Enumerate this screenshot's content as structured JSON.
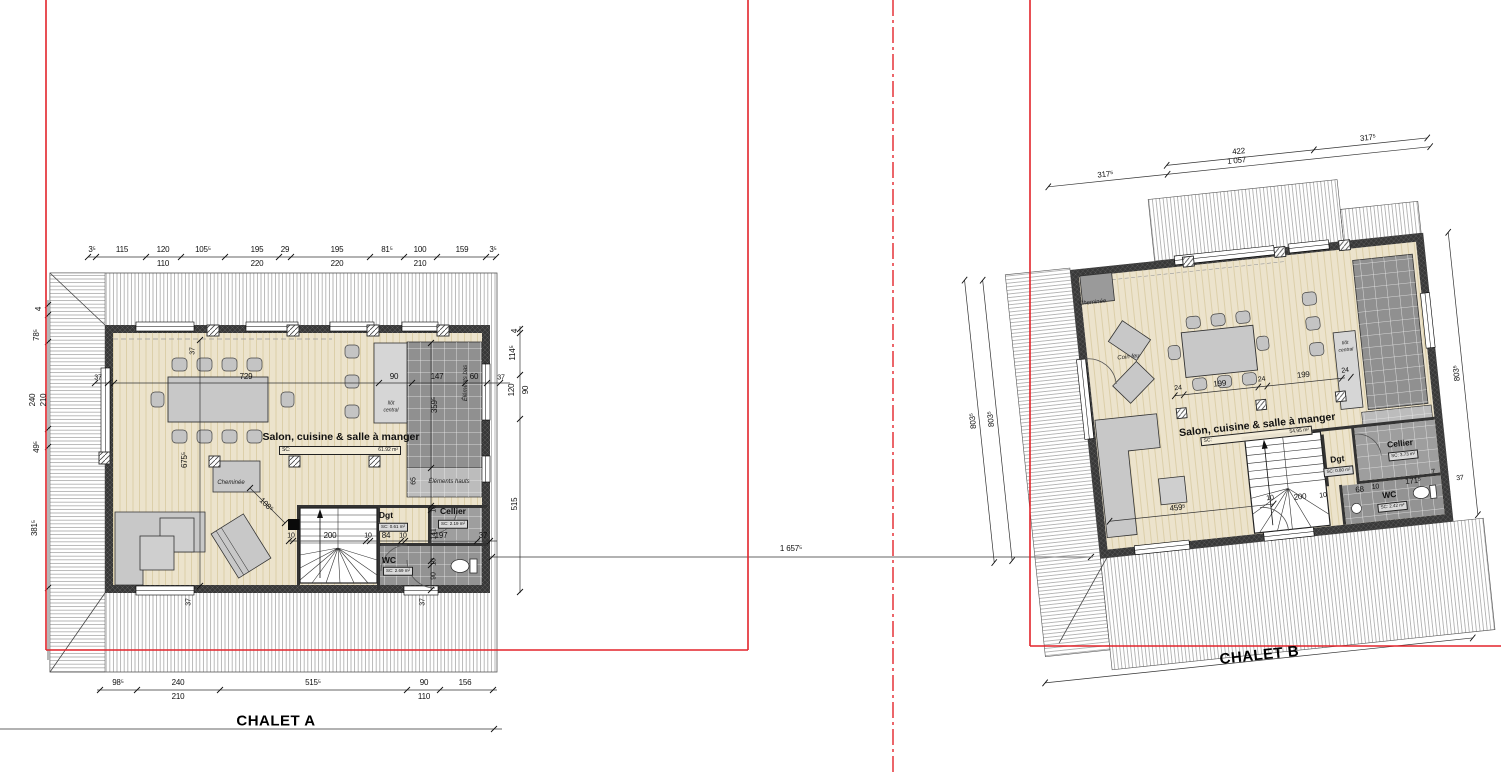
{
  "colors": {
    "boundary_red": "#e3242b",
    "wall_dark": "#383838",
    "floor_beige": "#ece3cc",
    "counter_gray": "#909090",
    "furniture_gray": "#c8c8c8"
  },
  "parcel": {
    "between_dim": "1 657⁵"
  },
  "chaletA": {
    "title": "CHALET A",
    "salon": {
      "name": "Salon, cuisine & salle à manger",
      "sc_label": "SC:",
      "sc_value": "61.92 m²"
    },
    "rooms": {
      "dgt": "Dgt",
      "dgt_sc": "SC: 0.61 m²",
      "cellier": "Cellier",
      "cellier_sc": "SC: 2.19 m²",
      "wc": "WC",
      "wc_sc": "SC: 2.69 m²"
    },
    "features": {
      "cheminee": "Cheminée",
      "ilot_line1": "Ilôt",
      "ilot_line2": "central",
      "elements_bas": "Éléments bas",
      "elements_hauts": "Éléments hauts"
    },
    "dims": {
      "top_primary": [
        "3⁵",
        "115",
        "120",
        "105⁵",
        "195",
        "29",
        "195",
        "81⁵",
        "100",
        "159",
        "3⁵"
      ],
      "top_secondary": [
        "110",
        "220",
        "220",
        "210"
      ],
      "left": [
        "4",
        "78⁵",
        "240",
        "210",
        "49⁵",
        "381⁵"
      ],
      "right": [
        "4",
        "114⁵",
        "120",
        "90",
        "515"
      ],
      "bottom_primary": [
        "98⁵",
        "240",
        "515⁵",
        "90",
        "156"
      ],
      "bottom_secondary": [
        "210",
        "110"
      ],
      "mid_row": [
        "37",
        "729",
        "90",
        "147",
        "60",
        "37"
      ],
      "stairs_row": [
        "10",
        "200",
        "10",
        "84",
        "10",
        "197",
        "37"
      ],
      "vertical_left": [
        "37",
        "675⁵",
        "37"
      ],
      "vertical_right": [
        "359⁵",
        "65",
        "10",
        "141",
        "10",
        "90",
        "37"
      ],
      "diagonal": "108⁵"
    }
  },
  "chaletB": {
    "title": "CHALET B",
    "salon": {
      "name": "Salon, cuisine & salle à manger",
      "sc_label": "SC:",
      "sc_value": "54.95 m²"
    },
    "rooms": {
      "dgt": "Dgt",
      "dgt_sc": "SC: 0.80 m²",
      "cellier": "Cellier",
      "cellier_sc": "SC: 3.73 m²",
      "wc": "WC",
      "wc_sc": "SC: 2.42 m²"
    },
    "features": {
      "cheminee": "Cheminée",
      "coin_feu": "Coin feu",
      "ilot_line1": "Ilôt",
      "ilot_line2": "central"
    },
    "dims": {
      "top_upper": [
        "422",
        "317⁵"
      ],
      "top_lower": [
        "317⁵",
        "1 057"
      ],
      "left": [
        "803⁵",
        "803⁵"
      ],
      "right": [
        "803⁵",
        "37"
      ],
      "mid_row": [
        "24",
        "199",
        "24",
        "199",
        "24"
      ],
      "sofa_dim": "459⁵",
      "stairs_row": [
        "10",
        "200",
        "10",
        "68",
        "10"
      ],
      "wc_row": [
        "171⁵",
        "7"
      ]
    }
  }
}
